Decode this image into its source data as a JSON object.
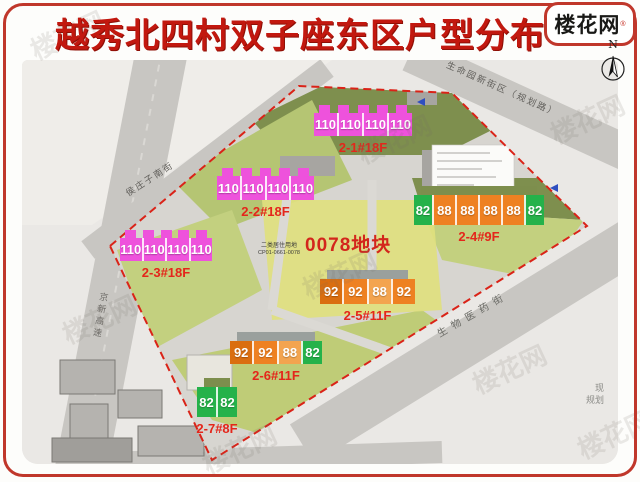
{
  "header": {
    "title": "越秀北四村双子座东区户型分布",
    "logo": "楼花网",
    "logo_mark": "®",
    "compass_label": "N"
  },
  "site": {
    "parcel_label": "0078地块",
    "land_use": "二类居住用地",
    "land_code": "CP01-0661-0078"
  },
  "buildings": [
    {
      "id": "2-1",
      "label": "2-1#18F",
      "units": [
        {
          "v": "110",
          "t": "m"
        },
        {
          "v": "110",
          "t": "m"
        },
        {
          "v": "110",
          "t": "m"
        },
        {
          "v": "110",
          "t": "m"
        }
      ]
    },
    {
      "id": "2-2",
      "label": "2-2#18F",
      "units": [
        {
          "v": "110",
          "t": "m"
        },
        {
          "v": "110",
          "t": "m"
        },
        {
          "v": "110",
          "t": "m"
        },
        {
          "v": "110",
          "t": "m"
        }
      ]
    },
    {
      "id": "2-3",
      "label": "2-3#18F",
      "units": [
        {
          "v": "110",
          "t": "m"
        },
        {
          "v": "110",
          "t": "m"
        },
        {
          "v": "110",
          "t": "m"
        },
        {
          "v": "110",
          "t": "m"
        }
      ]
    },
    {
      "id": "2-4",
      "label": "2-4#9F",
      "units": [
        {
          "v": "82",
          "t": "g"
        },
        {
          "v": "88",
          "t": "o"
        },
        {
          "v": "88",
          "t": "o"
        },
        {
          "v": "88",
          "t": "o"
        },
        {
          "v": "88",
          "t": "o"
        },
        {
          "v": "82",
          "t": "g"
        }
      ]
    },
    {
      "id": "2-5",
      "label": "2-5#11F",
      "units": [
        {
          "v": "92",
          "t": "od"
        },
        {
          "v": "92",
          "t": "o"
        },
        {
          "v": "88",
          "t": "ol"
        },
        {
          "v": "92",
          "t": "o"
        }
      ]
    },
    {
      "id": "2-6",
      "label": "2-6#11F",
      "units": [
        {
          "v": "92",
          "t": "od"
        },
        {
          "v": "92",
          "t": "o"
        },
        {
          "v": "88",
          "t": "ol"
        },
        {
          "v": "82",
          "t": "g"
        }
      ]
    },
    {
      "id": "2-7",
      "label": "2-7#8F",
      "units": [
        {
          "v": "82",
          "t": "g"
        },
        {
          "v": "82",
          "t": "g"
        }
      ]
    }
  ],
  "roads": {
    "northwest": "侯庄子南街",
    "northeast": "生命园新街区（规划路）",
    "southeast": "生物医药街",
    "west": "京新高速"
  },
  "corner_note": {
    "line1": "现",
    "line2": "规划"
  },
  "watermark": "楼花网",
  "colors": {
    "title_red": "#c2180f",
    "label_red": "#e4261b",
    "boundary_red": "#da2318",
    "unit_magenta": "#ee52dc",
    "unit_orange": "#ee8122",
    "unit_orange_dark": "#da6e10",
    "unit_orange_light": "#f3a44f",
    "unit_green": "#25b24a"
  }
}
